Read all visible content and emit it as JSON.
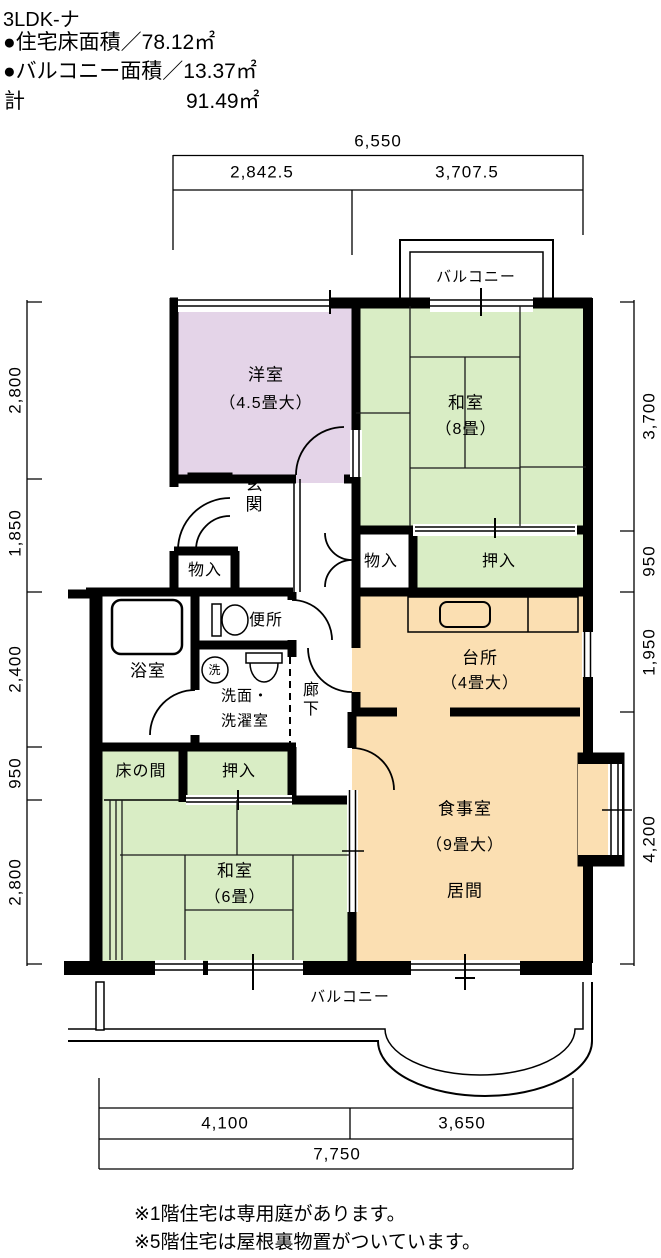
{
  "header": {
    "app_title": "3LDK-ナ",
    "floor_area": "●住宅床面積／78.12㎡",
    "balcony_area": "●バルコニー面積／13.37㎡",
    "total_label": "計",
    "total_value": "91.49㎡"
  },
  "dims": {
    "top": {
      "overall": "6,550",
      "left": "2,842.5",
      "right": "3,707.5"
    },
    "bottom": {
      "left": "4,100",
      "right": "3,650",
      "overall": "7,750"
    },
    "left": [
      "2,800",
      "1,850",
      "2,400",
      "950",
      "2,800"
    ],
    "right": [
      "3,700",
      "950",
      "1,950",
      "4,200"
    ]
  },
  "rooms": {
    "western": {
      "name": "洋室",
      "size": "（4.5畳大）"
    },
    "washitsu8": {
      "name": "和室",
      "size": "（8畳）"
    },
    "washitsu6": {
      "name": "和室",
      "size": "（6畳）"
    },
    "kitchen": {
      "name": "台所",
      "size": "（4畳大）"
    },
    "dining": {
      "name": "食事室",
      "size": "（9畳大）",
      "living": "居間"
    },
    "genkan": "玄関",
    "hallway": "廊下",
    "toilet": "便所",
    "bath": "浴室",
    "washroom_line1": "洗面・",
    "washroom_line2": "洗濯室",
    "washer_mark": "洗",
    "storage_top": "物入",
    "closet_top": "押入",
    "storage_entry": "物入",
    "tokonoma": "床の間",
    "closet_lower": "押入",
    "balcony_top": "バルコニー",
    "balcony_bottom": "バルコニー"
  },
  "notes": [
    "※1階住宅は専用庭があります。",
    "※5階住宅は屋根裏物置がついています。"
  ],
  "colors": {
    "tatami": "#d9edc5",
    "western": "#e4d4e8",
    "dining": "#fbdfb2",
    "wall": "#000000"
  }
}
